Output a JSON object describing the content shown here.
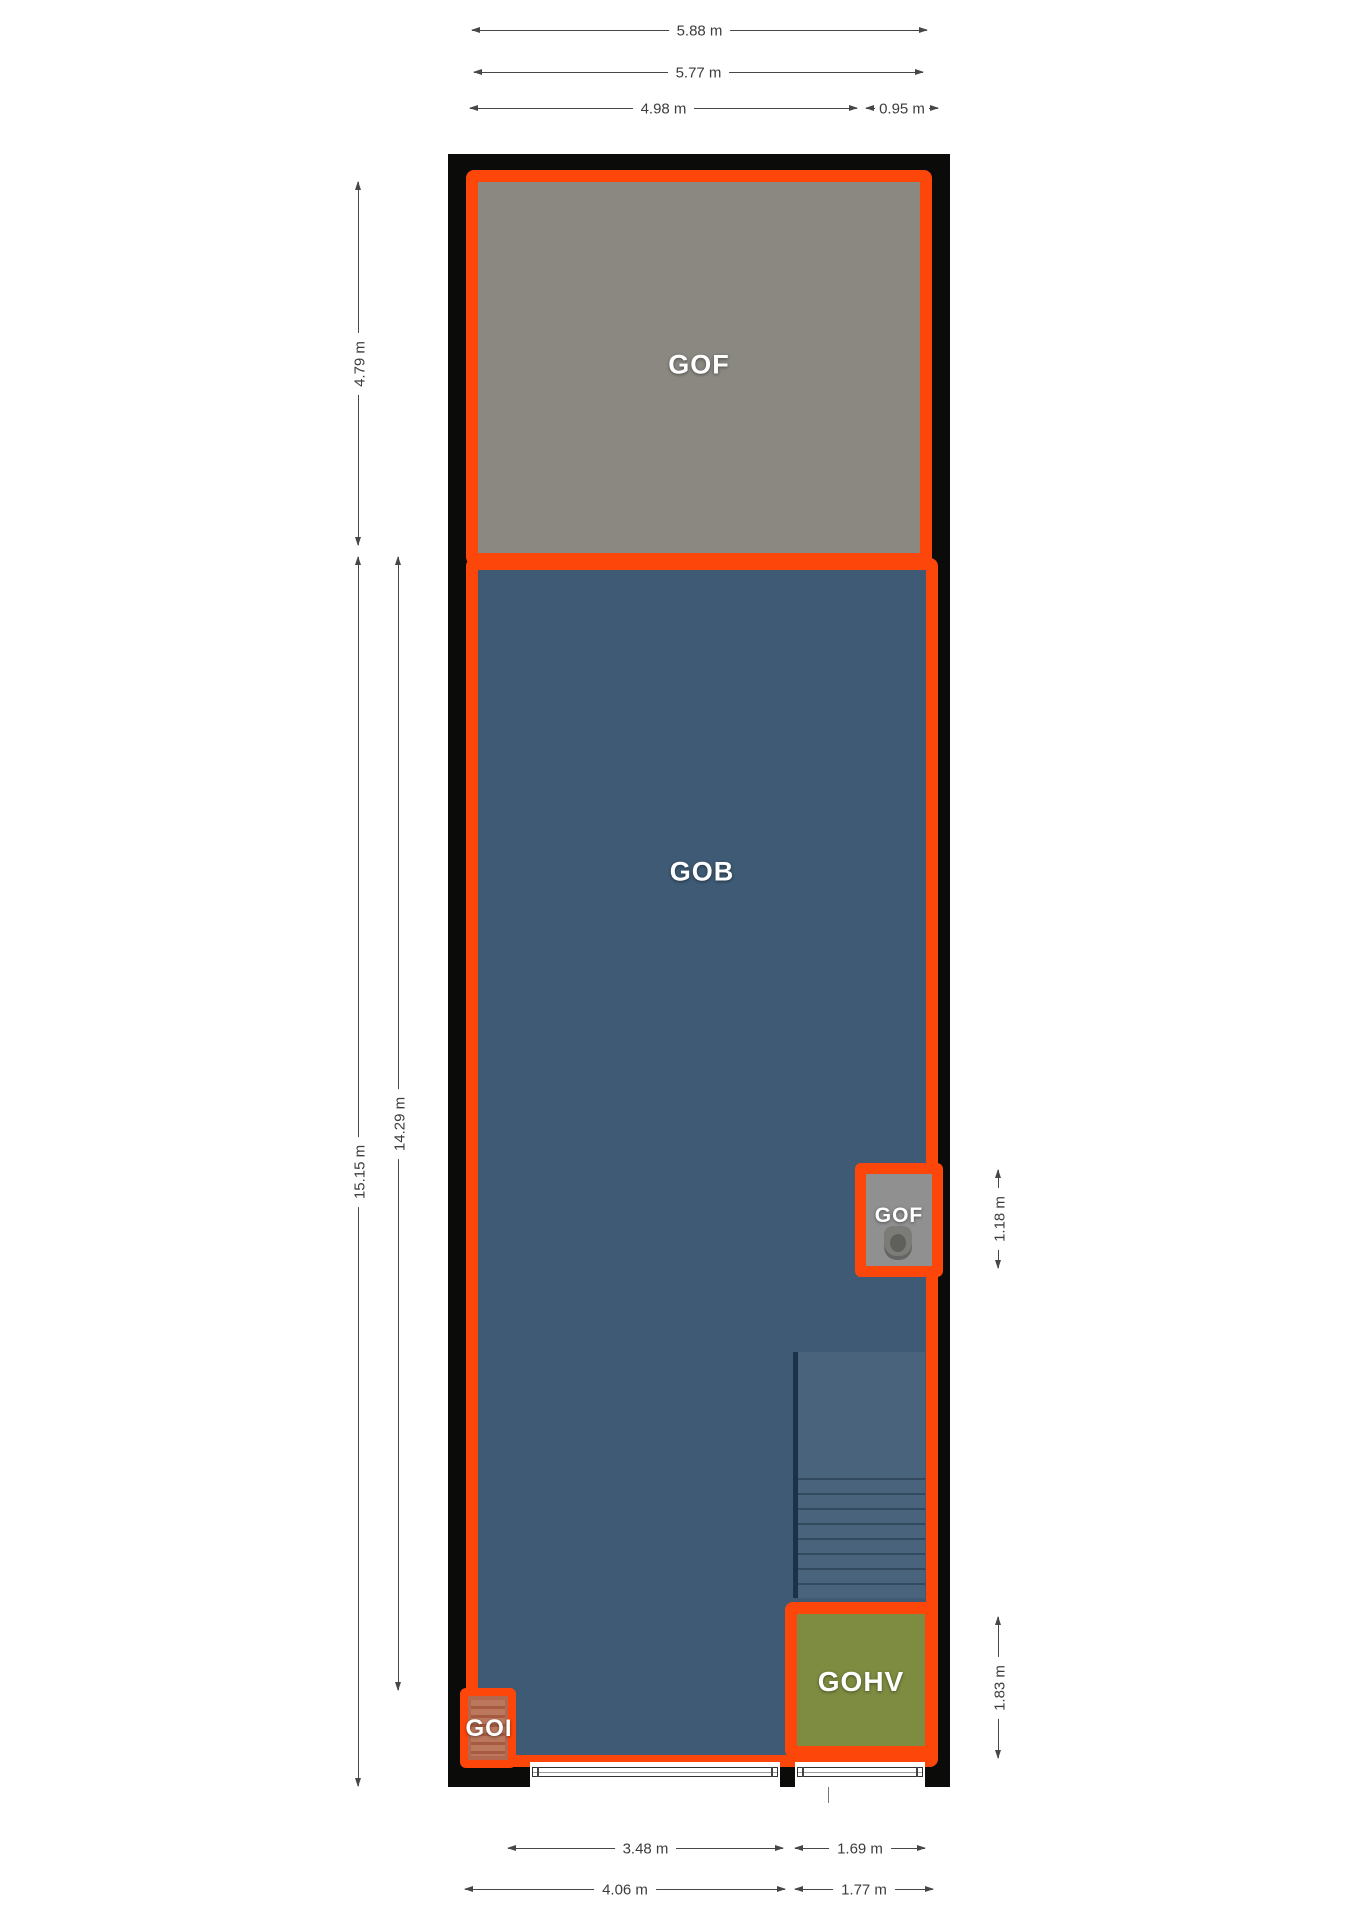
{
  "plan": {
    "rooms": {
      "gof_top": "GOF",
      "gob": "GOB",
      "gof_wc": "GOF",
      "gohv": "GOHV",
      "goi": "GOI"
    },
    "dims": {
      "t1": "5.88 m",
      "t2": "5.77 m",
      "t3": "4.98 m",
      "t4": "0.95 m",
      "l1": "4.79 m",
      "l2": "15.15 m",
      "l3": "14.29 m",
      "r1": "1.18 m",
      "r2": "1.83 m",
      "b1": "3.48 m",
      "b2": "1.69 m",
      "b3": "4.06 m",
      "b4": "1.77 m"
    },
    "colors": {
      "room_border": "#fc460a",
      "wall": "#0b0b0a",
      "gof_fill": "#8b8882",
      "gob_fill": "#3e5a74",
      "gohv_fill": "#7d8c40",
      "goi_fill": "#b26850",
      "wc_fill": "#909090",
      "dimension_text": "#3d3d3d",
      "background": "#ffffff"
    }
  }
}
